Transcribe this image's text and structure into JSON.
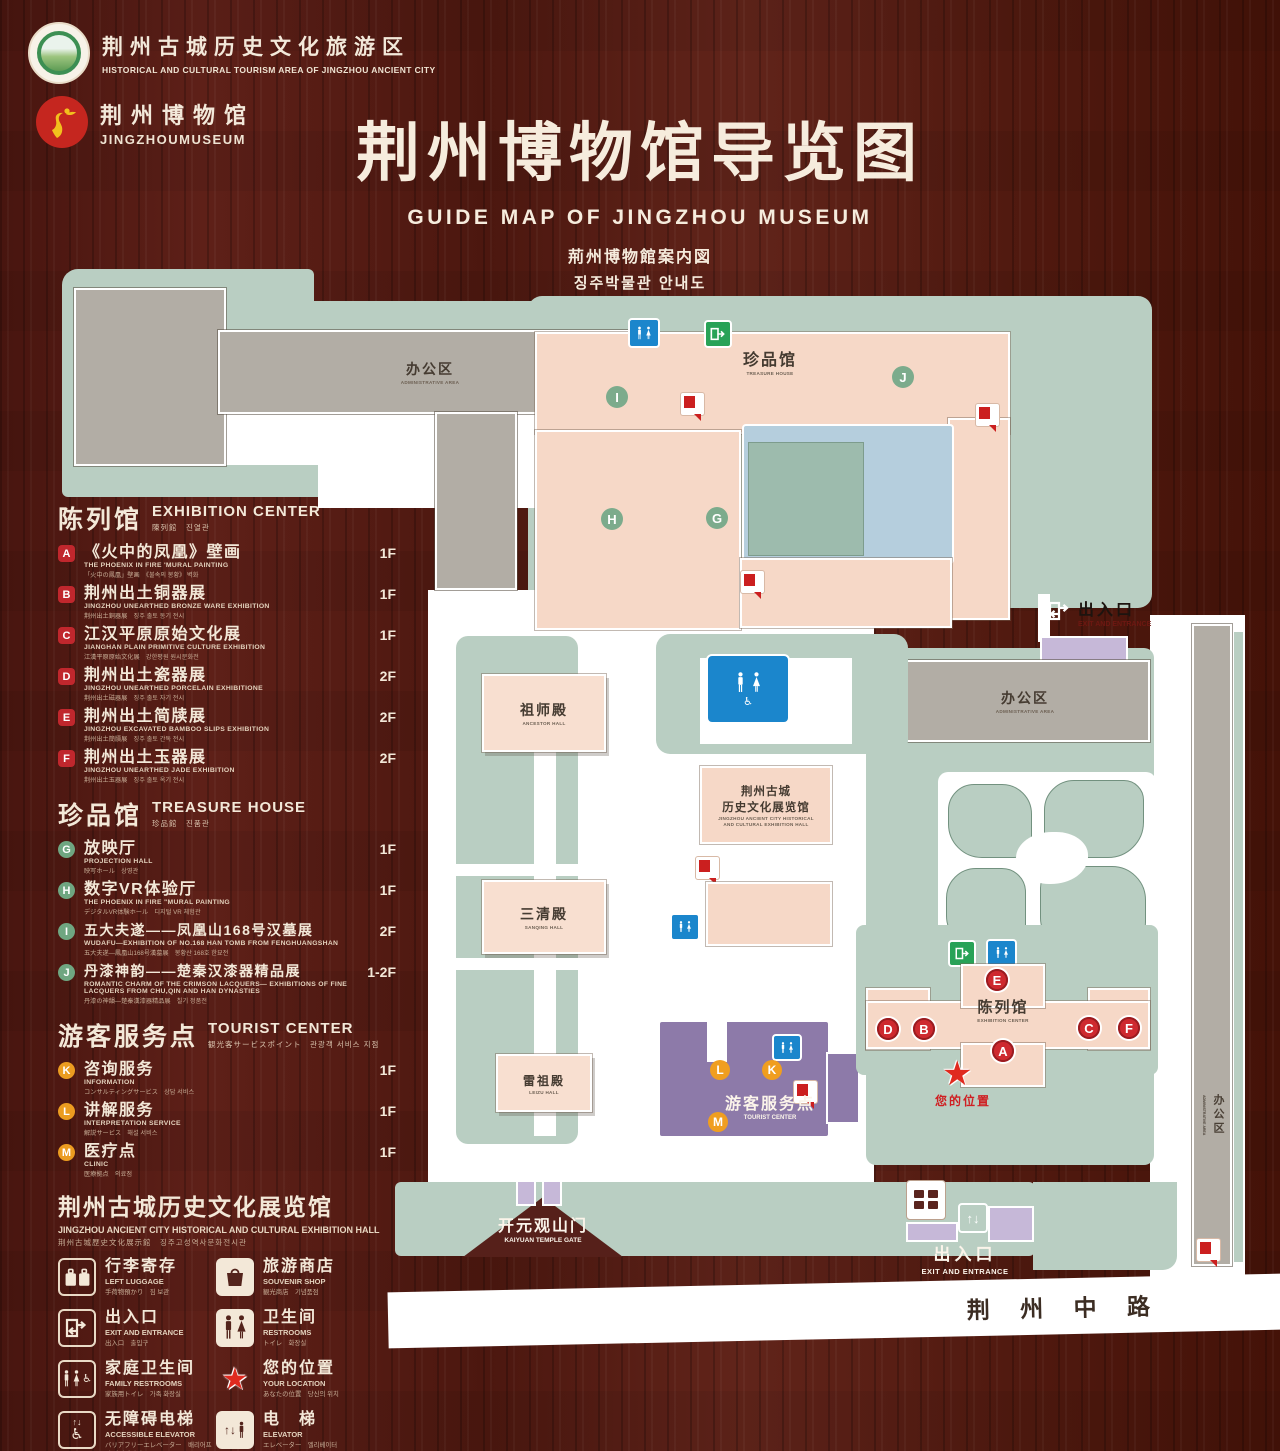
{
  "header": {
    "tourism_logo": {
      "cn": "荆州古城历史文化旅游区",
      "en": "HISTORICAL AND CULTURAL TOURISM AREA OF JINGZHOU ANCIENT CITY"
    },
    "museum_logo": {
      "cn": "荆州博物馆",
      "en": "JINGZHOUMUSEUM"
    },
    "title": "荆州博物馆导览图",
    "subtitle_en": "GUIDE MAP OF JINGZHOU MUSEUM",
    "subtitle_jp": "荊州博物館案内図",
    "subtitle_kr": "징주박물관 안내도"
  },
  "legend": {
    "sections": [
      {
        "title_cn": "陈列馆",
        "title_en": "EXHIBITION CENTER",
        "title_sub": "陳列館　진열관",
        "items": [
          {
            "letter": "A",
            "cn": "《火中的凤凰》壁画",
            "en": "THE PHOENIX IN FIRE 'MURAL PAINTING",
            "sub": "「火中の鳳凰」壁画　《불속의 봉황》 벽화",
            "floor": "1F"
          },
          {
            "letter": "B",
            "cn": "荆州出土铜器展",
            "en": "JINGZHOU UNEARTHED BRONZE WARE EXHIBITION",
            "sub": "荆州出土銅器展　징주 출토 동기 전시",
            "floor": "1F"
          },
          {
            "letter": "C",
            "cn": "江汉平原原始文化展",
            "en": "JIANGHAN PLAIN PRIMITIVE CULTURE EXHIBITION",
            "sub": "江漢平原原始文化展　강한평원 원시문화전",
            "floor": "1F"
          },
          {
            "letter": "D",
            "cn": "荆州出土瓷器展",
            "en": "JINGZHOU UNEARTHED PORCELAIN EXHIBITIONE",
            "sub": "荆州出土磁器展　징주 출토 자기 전시",
            "floor": "2F"
          },
          {
            "letter": "E",
            "cn": "荆州出土简牍展",
            "en": "JINGZHOU EXCAVATED BAMBOO SLIPS EXHIBITION",
            "sub": "荆州出土簡牘展　징주 출토 간독 전시",
            "floor": "2F"
          },
          {
            "letter": "F",
            "cn": "荆州出土玉器展",
            "en": "JINGZHOU UNEARTHED JADE EXHIBITION",
            "sub": "荆州出土玉器展　징주 출토 옥기 전시",
            "floor": "2F"
          }
        ]
      },
      {
        "title_cn": "珍品馆",
        "title_en": "TREASURE HOUSE",
        "title_sub": "珍品館　진품관",
        "items": [
          {
            "letter": "G",
            "cn": "放映厅",
            "en": "PROJECTION HALL",
            "sub": "映写ホール　상영관",
            "floor": "1F"
          },
          {
            "letter": "H",
            "cn": "数字VR体验厅",
            "en": "THE PHOENIX IN FIRE \"MURAL PAINTING",
            "sub": "デジタルVR体験ホール　디지털 VR 체험관",
            "floor": "1F"
          },
          {
            "letter": "I",
            "cn": "五大夫遂——凤凰山168号汉墓展",
            "en": "WUDAFU—EXHIBITION OF NO.168 HAN TOMB FROM FENGHUANGSHAN",
            "sub": "五大夫遂—鳳凰山168号漢墓展　봉황산 168호 한묘전",
            "floor": "2F"
          },
          {
            "letter": "J",
            "cn": "丹漆神韵——楚秦汉漆器精品展",
            "en": "ROMANTIC CHARM OF THE CRIMSON LACQUERS— EXHIBITIONS OF FINE LACQUERS FROM CHU,QIN AND HAN DYNASTIES",
            "sub": "丹漆の神韻—楚秦漢漆器精品展　칠기 정품전",
            "floor": "1-2F"
          }
        ]
      },
      {
        "title_cn": "游客服务点",
        "title_en": "TOURIST CENTER",
        "title_sub": "観光客サービスポイント　관광객 서비스 지점",
        "items": [
          {
            "letter": "K",
            "cn": "咨询服务",
            "en": "INFORMATION",
            "sub": "コンサルティングサービス　상담 서비스",
            "floor": "1F"
          },
          {
            "letter": "L",
            "cn": "讲解服务",
            "en": "INTERPRETATION SERVICE",
            "sub": "解説サービス　해설 서비스",
            "floor": "1F"
          },
          {
            "letter": "M",
            "cn": "医疗点",
            "en": "CLINIC",
            "sub": "医療拠点　의료점",
            "floor": "1F"
          }
        ]
      }
    ],
    "hall_heading": {
      "cn": "荆州古城历史文化展览馆",
      "en": "JINGZHOU ANCIENT CITY HISTORICAL AND CULTURAL EXHIBITION HALL",
      "sub": "荆州古城歴史文化展示館　징주고성역사문화전시관"
    },
    "icons": [
      {
        "name": "left-luggage",
        "cn": "行李寄存",
        "en": "LEFT LUGGAGE",
        "sub": "手荷物預かり　짐 보관"
      },
      {
        "name": "souvenir-shop",
        "cn": "旅游商店",
        "en": "SOUVENIR SHOP",
        "sub": "観光商店　기념품점"
      },
      {
        "name": "exit-entrance",
        "cn": "出入口",
        "en": "EXIT AND ENTRANCE",
        "sub": "出入口　출입구"
      },
      {
        "name": "restrooms",
        "cn": "卫生间",
        "en": "RESTROOMS",
        "sub": "トイレ　화장실"
      },
      {
        "name": "family-restrooms",
        "cn": "家庭卫生间",
        "en": "FAMILY RESTROOMS",
        "sub": "家族用トイレ　가족 화장실"
      },
      {
        "name": "your-location",
        "cn": "您的位置",
        "en": "YOUR LOCATION",
        "sub": "あなたの位置　당신의 위치"
      },
      {
        "name": "accessible-elevator",
        "cn": "无障碍电梯",
        "en": "ACCESSIBLE ELEVATOR",
        "sub": "バリアフリーエレベーター　배리어프리 엘리베이터"
      },
      {
        "name": "elevator",
        "cn": "电　梯",
        "en": "ELEVATOR",
        "sub": "エレベーター　엘리베이터"
      },
      {
        "name": "display-area",
        "cn": "展示区域",
        "en": "DISPLAY AREA",
        "sub": "展示エリア　전시 영역"
      },
      {
        "name": "office-area",
        "cn": "办公区域",
        "en": "OFFICE AREA",
        "sub": "オフィスエリア　사무실 구역"
      }
    ]
  },
  "map": {
    "admin": {
      "cn": "办公区",
      "en": "ADMINISTRATIVE AREA"
    },
    "treasure": {
      "cn": "珍品馆",
      "en": "TREASURE HOUSE"
    },
    "ancestor": {
      "cn": "祖师殿",
      "en": "ANCESTOR HALL"
    },
    "sanqing": {
      "cn": "三清殿",
      "en": "SANQING HALL"
    },
    "leizu": {
      "cn": "雷祖殿",
      "en": "LEIZU HALL"
    },
    "exhibition_hall": {
      "cn1": "荆州古城",
      "cn2": "历史文化展览馆",
      "en1": "JINGZHOU ANCIENT CITY HISTORICAL",
      "en2": "AND CULTURAL EXHIBITION HALL"
    },
    "exhibition_center": {
      "cn": "陈列馆",
      "en": "EXHIBITION CENTER"
    },
    "tourist": {
      "cn": "游客服务点",
      "en": "TOURIST CENTER"
    },
    "your_location": "您的位置",
    "exit": {
      "cn": "出入口",
      "en": "EXIT AND ENTRANCE"
    },
    "gate": {
      "cn": "开元观山门",
      "en": "KAIYUAN TEMPLE GATE"
    },
    "road": "荆 州 中 路"
  }
}
